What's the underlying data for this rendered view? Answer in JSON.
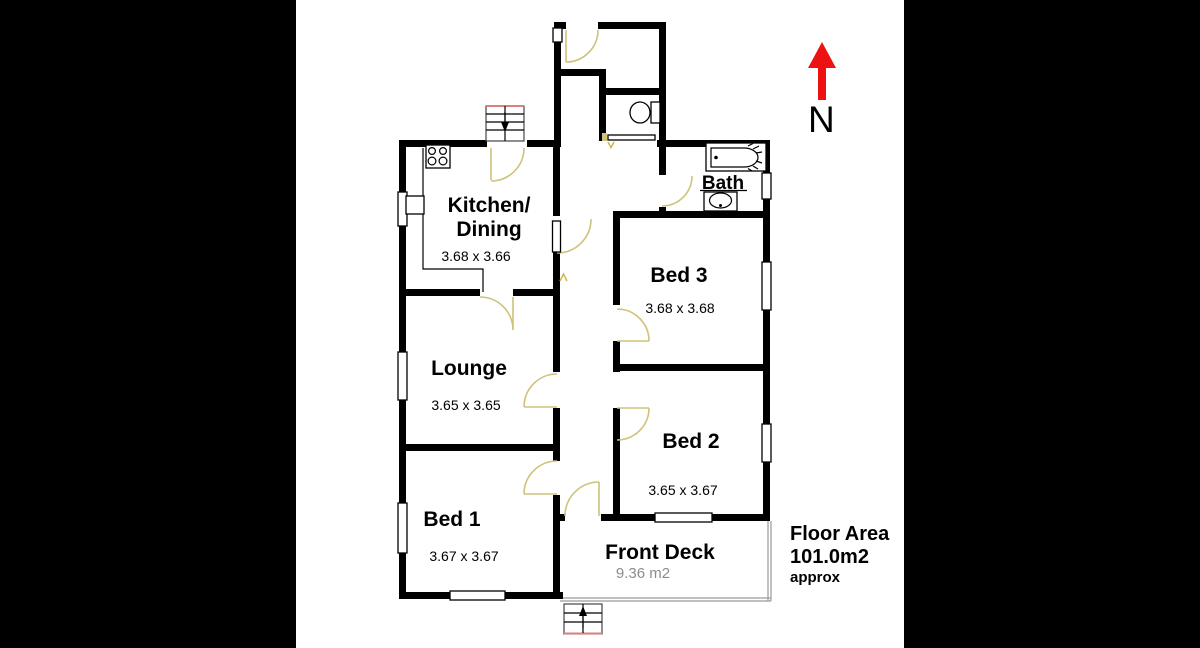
{
  "plan": {
    "rooms": [
      {
        "id": "kitchen-dining",
        "label_line1": "Kitchen/",
        "label_line2": "Dining",
        "dimensions": "3.68 x 3.66"
      },
      {
        "id": "lounge",
        "label": "Lounge",
        "dimensions": "3.65 x 3.65"
      },
      {
        "id": "bed-1",
        "label": "Bed 1",
        "dimensions": "3.67 x 3.67"
      },
      {
        "id": "bed-2",
        "label": "Bed 2",
        "dimensions": "3.65 x 3.67"
      },
      {
        "id": "bed-3",
        "label": "Bed 3",
        "dimensions": "3.68 x 3.68"
      },
      {
        "id": "bath",
        "label": "Bath"
      },
      {
        "id": "front-deck",
        "label": "Front Deck",
        "area": "9.36 m2"
      }
    ],
    "annotations": {
      "floor_area_title": "Floor Area",
      "floor_area_value": "101.0m2",
      "floor_area_qualifier": "approx",
      "compass_label": "N"
    },
    "fixtures": [
      "stove-icon",
      "kitchen-bench",
      "sink-icon",
      "toilet-icon",
      "bathtub-icon",
      "vanity-basin-icon",
      "rear-stairs-icon",
      "front-steps-icon",
      "wc-sliding-door",
      "north-arrow-icon"
    ],
    "colors": {
      "wall": "#000000",
      "door_swing": "#cfc27a",
      "north_arrow": "#ee1111",
      "deck_outline": "#9a9a9a",
      "secondary_text": "#8c8c8c",
      "plan_background": "#ffffff",
      "side_panels": "#000000"
    }
  }
}
